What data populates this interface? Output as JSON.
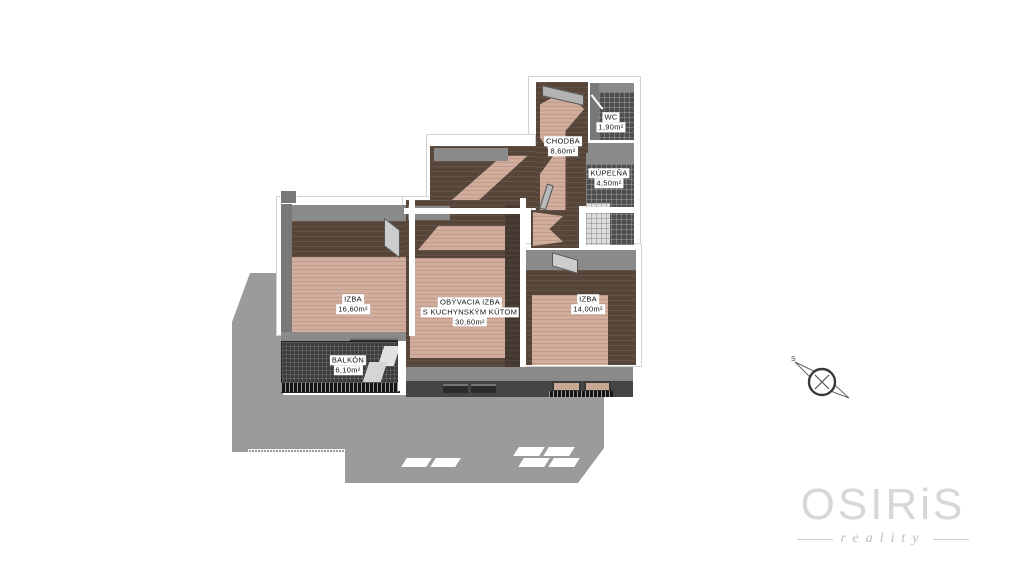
{
  "floorplan": {
    "rooms": [
      {
        "id": "chodba",
        "lines": [
          "CHODBA",
          "8,60m²"
        ]
      },
      {
        "id": "wc",
        "lines": [
          "WC",
          "1,90m²"
        ]
      },
      {
        "id": "kupelna",
        "lines": [
          "KÚPEĽŇA",
          "4,50m²"
        ]
      },
      {
        "id": "izba-left",
        "lines": [
          "IZBA",
          "16,60m²"
        ]
      },
      {
        "id": "obyvacia-izba",
        "lines": [
          "OBÝVACIA IZBA",
          "S KUCHYNSKÝM KÚTOM",
          "30,60m²"
        ]
      },
      {
        "id": "izba-right",
        "lines": [
          "IZBA",
          "14,00m²"
        ]
      },
      {
        "id": "balkon",
        "lines": [
          "BALKÓN",
          "6,10m²"
        ]
      }
    ],
    "compass": {
      "north_label": "S"
    }
  },
  "watermark": {
    "brand": "OSIRiS",
    "tagline": "reality"
  },
  "colors": {
    "background": "#ffffff",
    "platform_gray": "#9b9b9b",
    "facade_gray": "#454545",
    "wall_top_gray": "#8a8a8a",
    "wall_side_gray": "#787878",
    "floor_wood_dark": "#57453a",
    "floor_wood_light": "#d0ad9c",
    "tile_dark": "#4f4f4f",
    "tile_light": "#dcdcdc",
    "balcony_dark": "#3c3c3c",
    "label_bg": "#ffffff",
    "label_text": "#111111",
    "logo_gray": "#d7d7d7"
  }
}
